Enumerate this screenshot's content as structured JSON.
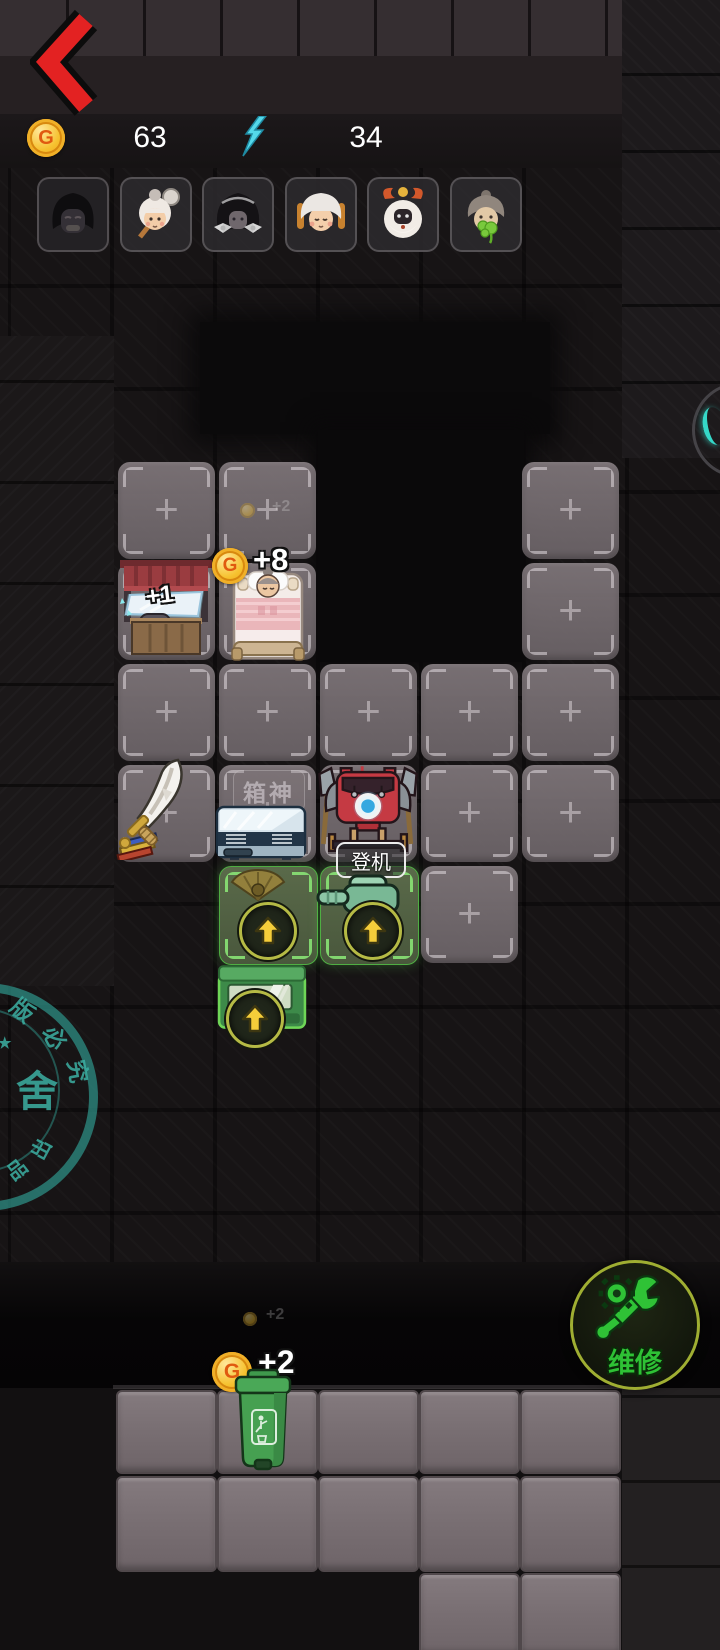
{
  "topbar": {
    "coin_letter": "G",
    "coins": "63",
    "energy": "34"
  },
  "board": {
    "ghost_bonus": "+2",
    "desk_bonus": "+1",
    "bed_bonus": "+8",
    "slot_label": "箱神",
    "embark": "登机"
  },
  "bottom": {
    "repair": "维修",
    "coin_letter": "G",
    "trash_bonus": "+2",
    "trash_ghost": "+2"
  },
  "watermark": {
    "top": [
      "版",
      "必",
      "究"
    ],
    "star": "★",
    "center": "舍",
    "bottom": [
      "出",
      "品"
    ]
  },
  "colors": {
    "accent_green": "#2ec135",
    "coin_gold": "#f6c12e",
    "energy_cyan": "#54d8ea",
    "back_red": "#e32222",
    "watermark_teal": "#2f9a8e"
  }
}
